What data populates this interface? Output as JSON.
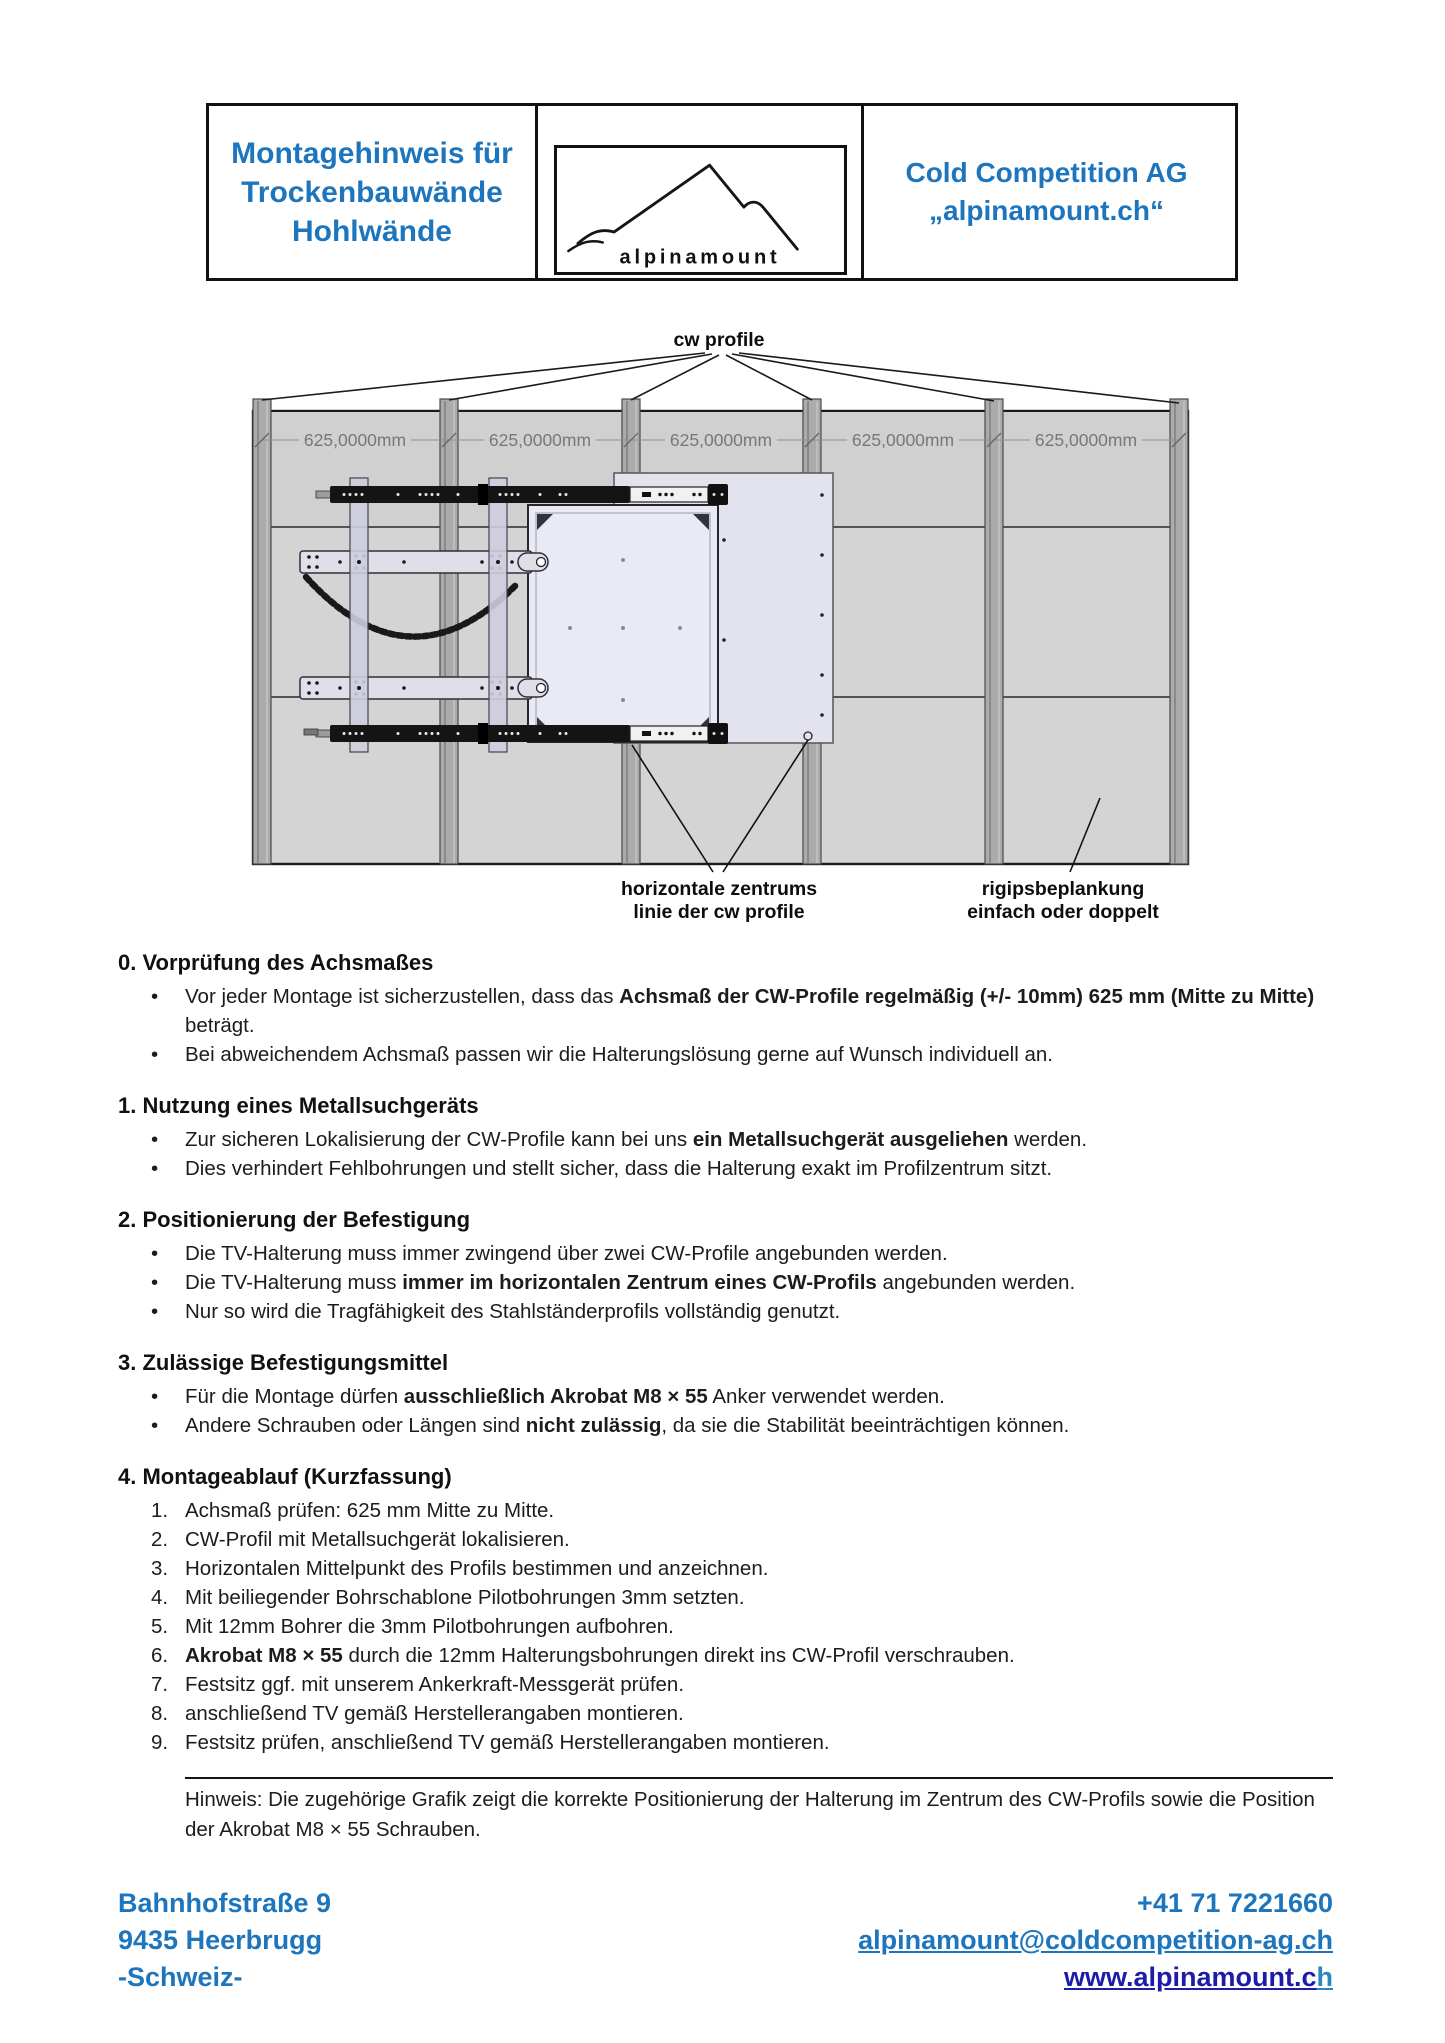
{
  "header": {
    "title_lines": [
      "Montagehinweis für",
      "Trockenbauwände",
      "Hohlwände"
    ],
    "logo_text": "alpinamount",
    "company_line_1": "Cold Competition AG",
    "company_line_2": "„alpinamount.ch“",
    "accent_color": "#1d76bd"
  },
  "diagram": {
    "cw_profile_label": "cw profile",
    "dimension_label": "625,0000mm",
    "dimension_count": 5,
    "center_label_line_1": "horizontale zentrums",
    "center_label_line_2": "linie der cw profile",
    "plank_label_line_1": "rigipsbeplankung",
    "plank_label_line_2": "einfach oder doppelt",
    "wall_color": "#d4d4d4",
    "stud_color": "#ababab",
    "mount_color": "#dfdfe9"
  },
  "sections": [
    {
      "heading": "0. Vorprüfung des Achsmaßes",
      "items": [
        {
          "marker": "•",
          "segments": [
            {
              "text": "Vor jeder Montage ist sicherzustellen, dass das "
            },
            {
              "text": "Achsmaß der CW-Profile regelmäßig (+/- 10mm) 625 mm (Mitte zu Mitte)",
              "bold": true
            },
            {
              "text": " beträgt."
            }
          ]
        },
        {
          "marker": "•",
          "segments": [
            {
              "text": "Bei abweichendem Achsmaß passen wir die Halterungslösung gerne auf Wunsch individuell an."
            }
          ]
        }
      ]
    },
    {
      "heading": "1. Nutzung eines Metallsuchgeräts",
      "items": [
        {
          "marker": "•",
          "segments": [
            {
              "text": "Zur sicheren Lokalisierung der CW-Profile kann bei uns "
            },
            {
              "text": "ein Metallsuchgerät ausgeliehen",
              "bold": true
            },
            {
              "text": " werden."
            }
          ]
        },
        {
          "marker": "•",
          "segments": [
            {
              "text": "Dies verhindert Fehlbohrungen und stellt sicher, dass die Halterung exakt im Profilzentrum sitzt."
            }
          ]
        }
      ]
    },
    {
      "heading": "2. Positionierung der Befestigung",
      "items": [
        {
          "marker": "•",
          "segments": [
            {
              "text": "Die TV-Halterung muss immer zwingend über zwei CW-Profile angebunden werden."
            }
          ]
        },
        {
          "marker": "•",
          "segments": [
            {
              "text": "Die TV-Halterung muss "
            },
            {
              "text": "immer im horizontalen Zentrum eines CW-Profils",
              "bold": true
            },
            {
              "text": " angebunden werden."
            }
          ]
        },
        {
          "marker": "•",
          "segments": [
            {
              "text": "Nur so wird die Tragfähigkeit des Stahlständerprofils vollständig genutzt."
            }
          ]
        }
      ]
    },
    {
      "heading": "3. Zulässige Befestigungsmittel",
      "items": [
        {
          "marker": "•",
          "segments": [
            {
              "text": "Für die Montage dürfen "
            },
            {
              "text": "ausschließlich Akrobat M8 × 55",
              "bold": true
            },
            {
              "text": " Anker verwendet werden."
            }
          ]
        },
        {
          "marker": "•",
          "segments": [
            {
              "text": "Andere Schrauben oder Längen sind "
            },
            {
              "text": "nicht zulässig",
              "bold": true
            },
            {
              "text": ", da sie die Stabilität beeinträchtigen können."
            }
          ]
        }
      ]
    },
    {
      "heading": "4. Montageablauf (Kurzfassung)",
      "items": [
        {
          "marker": "1.",
          "segments": [
            {
              "text": "Achsmaß prüfen: 625 mm Mitte zu Mitte."
            }
          ]
        },
        {
          "marker": "2.",
          "segments": [
            {
              "text": "CW-Profil mit Metallsuchgerät lokalisieren."
            }
          ]
        },
        {
          "marker": "3.",
          "segments": [
            {
              "text": "Horizontalen Mittelpunkt des Profils bestimmen und anzeichnen."
            }
          ]
        },
        {
          "marker": "4.",
          "segments": [
            {
              "text": "Mit beiliegender Bohrschablone Pilotbohrungen 3mm setzten."
            }
          ]
        },
        {
          "marker": "5.",
          "segments": [
            {
              "text": "Mit 12mm Bohrer die 3mm Pilotbohrungen aufbohren."
            }
          ]
        },
        {
          "marker": "6.",
          "segments": [
            {
              "text": "Akrobat M8 × 55",
              "bold": true
            },
            {
              "text": " durch die 12mm Halterungsbohrungen direkt ins CW-Profil verschrauben."
            }
          ]
        },
        {
          "marker": "7.",
          "segments": [
            {
              "text": "Festsitz ggf. mit unserem Ankerkraft-Messgerät prüfen."
            }
          ]
        },
        {
          "marker": "8.",
          "segments": [
            {
              "text": "anschließend TV gemäß Herstellerangaben montieren."
            }
          ]
        },
        {
          "marker": "9.",
          "segments": [
            {
              "text": "Festsitz prüfen, anschließend TV gemäß Herstellerangaben montieren."
            }
          ]
        }
      ]
    }
  ],
  "note": {
    "text": "Hinweis: Die zugehörige Grafik zeigt die korrekte Positionierung der Halterung im Zentrum des CW-Profils sowie die Position der Akrobat M8 × 55 Schrauben."
  },
  "footer": {
    "address_line_1": "Bahnhofstraße 9",
    "address_line_2": "9435 Heerbrugg",
    "address_line_3": "-Schweiz-",
    "phone": "+41 71 7221660",
    "email": "alpinamount@coldcompetition-ag.ch",
    "website_main": "www.alpinamount.c",
    "website_tail": "h",
    "link_color": "#1d76bd",
    "website_color": "#1c1ca8",
    "website_tail_color": "#2e86c1"
  }
}
